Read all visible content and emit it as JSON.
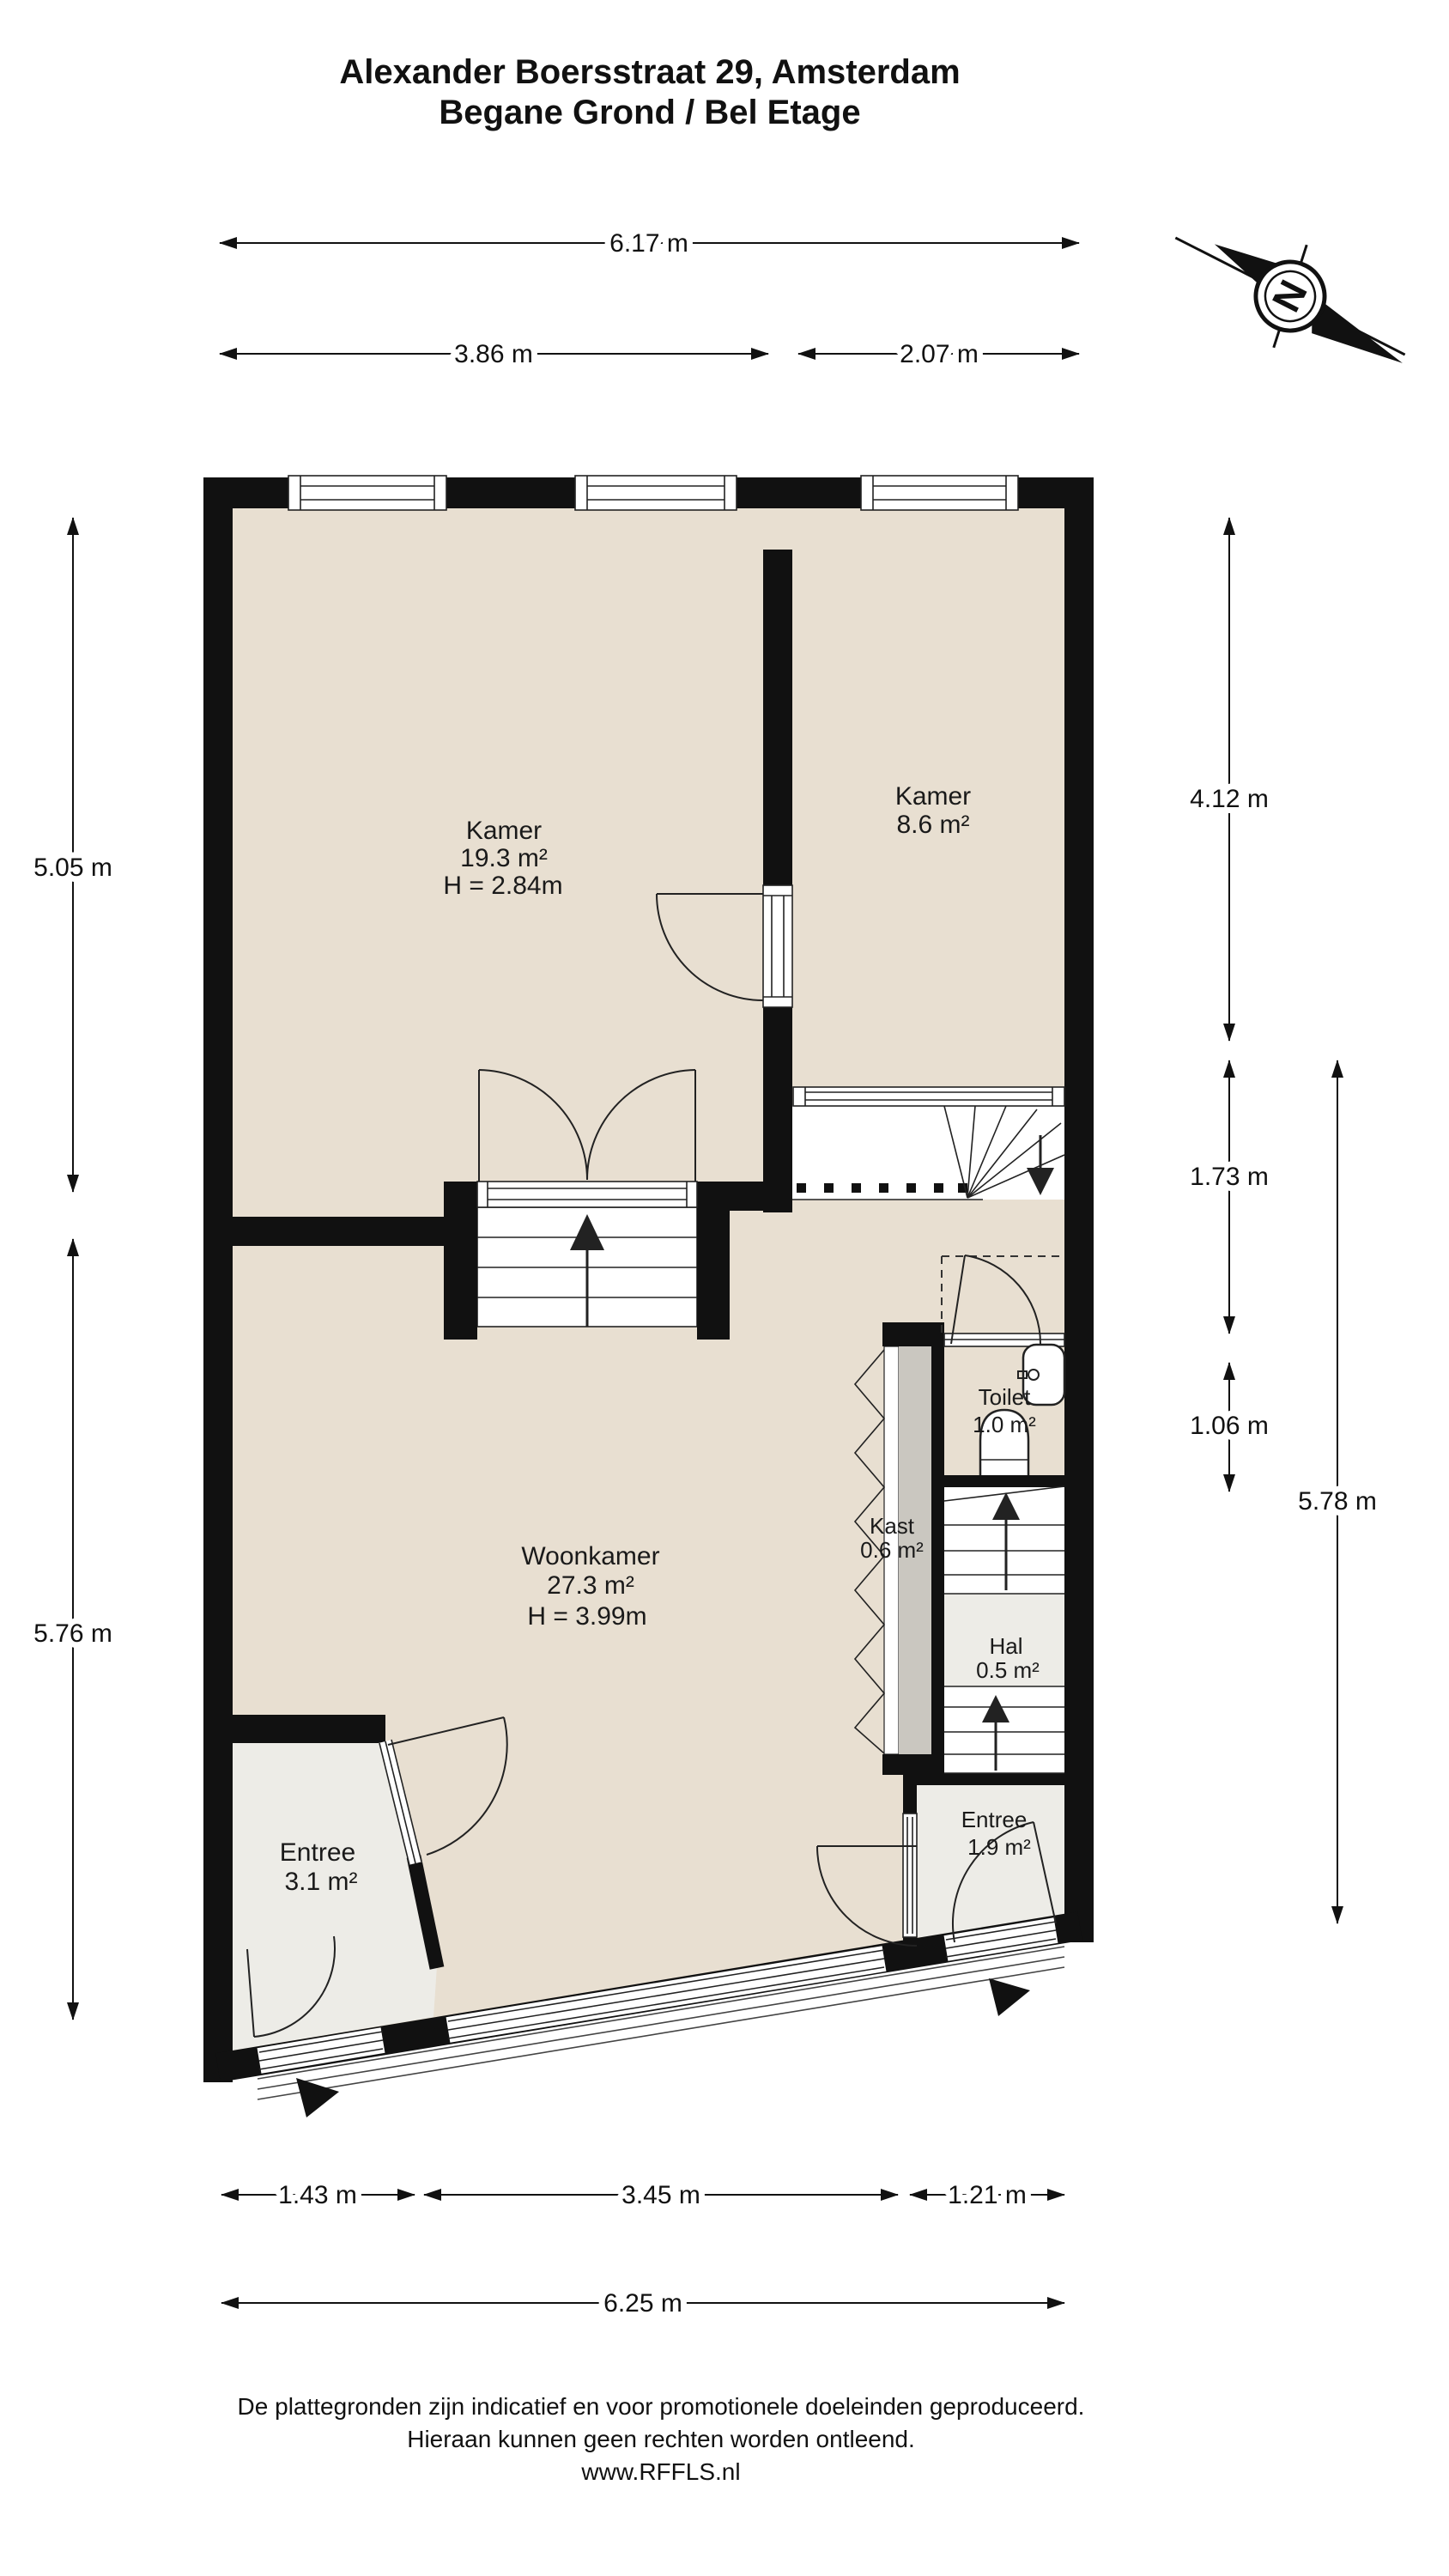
{
  "title": {
    "line1": "Alexander Boersstraat 29, Amsterdam",
    "line2": "Begane Grond / Bel Etage"
  },
  "compass": {
    "letter": "N"
  },
  "dimensions": {
    "top_total": "6.17 m",
    "top_left": "3.86 m",
    "top_right": "2.07 m",
    "left_upper": "5.05 m",
    "left_lower": "5.76 m",
    "right_upper": "4.12 m",
    "right_mid": "1.73 m",
    "right_small": "1.06 m",
    "right_total": "5.78 m",
    "bottom_left": "1.43 m",
    "bottom_mid": "3.45 m",
    "bottom_right": "1.21 m",
    "bottom_total": "6.25 m"
  },
  "rooms": {
    "kamer1": {
      "name": "Kamer",
      "area": "19.3 m²",
      "height": "H = 2.84m"
    },
    "kamer2": {
      "name": "Kamer",
      "area": "8.6 m²"
    },
    "woonkamer": {
      "name": "Woonkamer",
      "area": "27.3 m²",
      "height": "H = 3.99m"
    },
    "toilet": {
      "name": "Toilet",
      "area": "1.0 m²"
    },
    "kast": {
      "name": "Kast",
      "area": "0.6 m²"
    },
    "hal": {
      "name": "Hal",
      "area": "0.5 m²"
    },
    "entree1": {
      "name": "Entree",
      "area": "3.1 m²"
    },
    "entree2": {
      "name": "Entree",
      "area": "1.9 m²"
    }
  },
  "footer": {
    "line1": "De plattegronden zijn indicatief en voor promotionele doeleinden geproduceerd.",
    "line2": "Hieraan kunnen geen rechten worden ontleend.",
    "line3": "www.RFFLS.nl"
  },
  "colors": {
    "floor_main": "#e8dfd1",
    "floor_light": "#edece7",
    "closet_gray": "#cac7c0",
    "wall": "#111111"
  }
}
